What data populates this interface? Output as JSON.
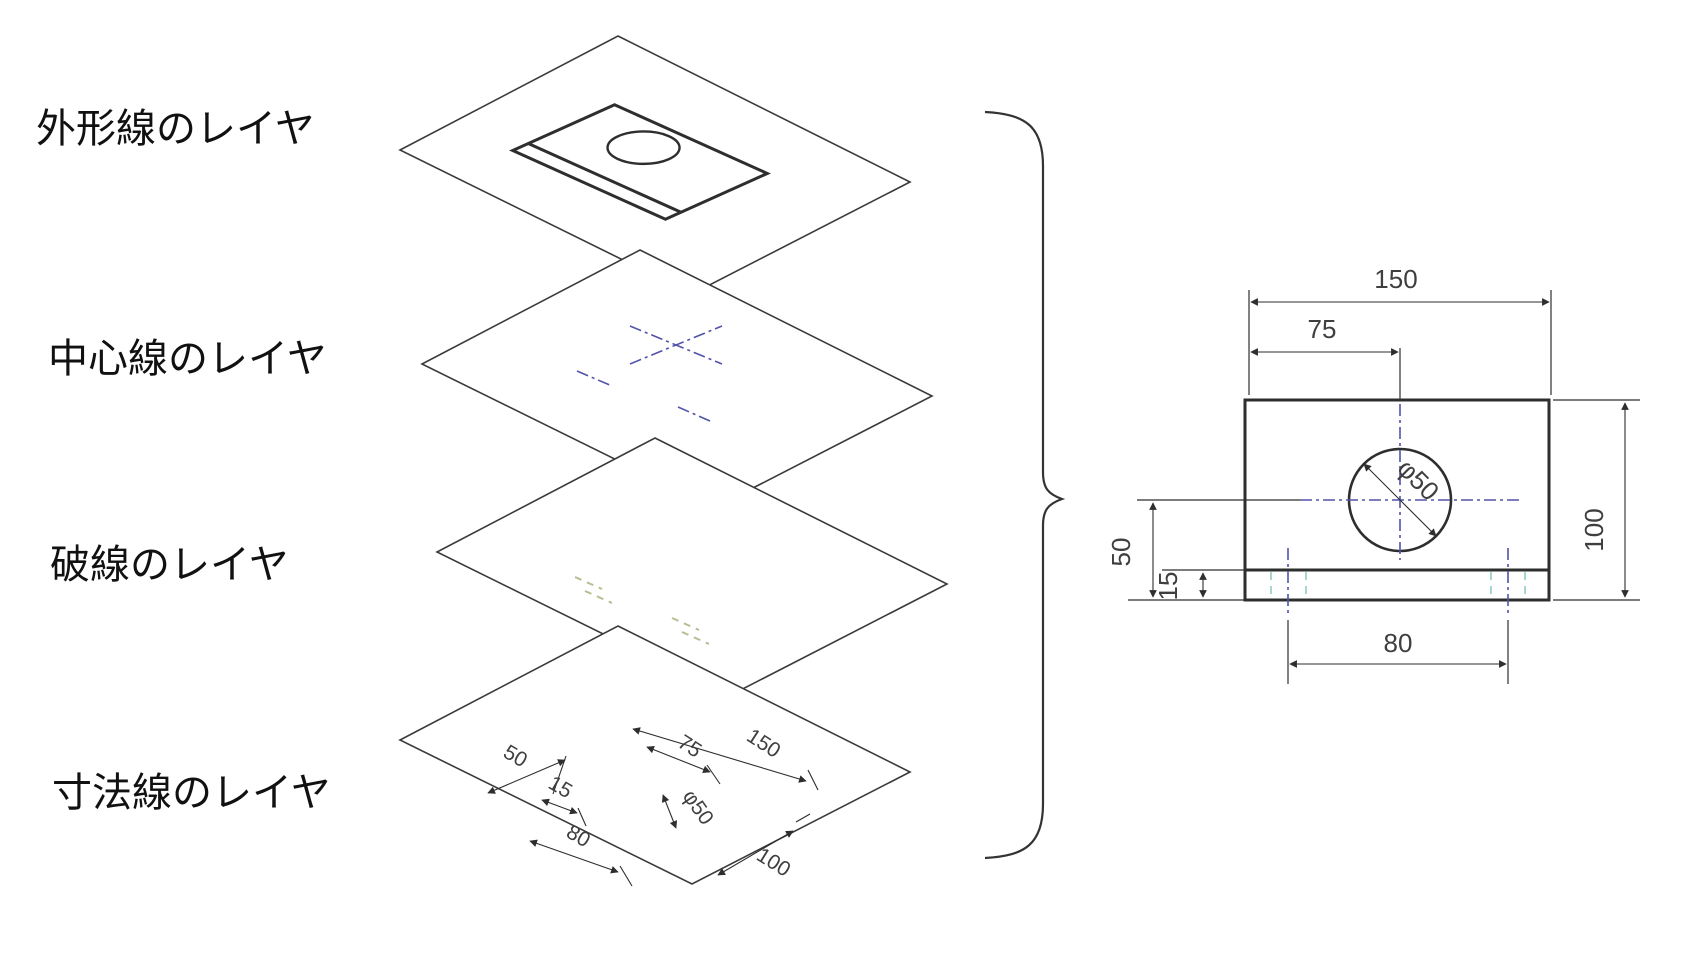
{
  "diagram_title": "CAD layers concept diagram",
  "layers": [
    {
      "label": "外形線のレイヤ"
    },
    {
      "label": "中心線のレイヤ"
    },
    {
      "label": "破線のレイヤ"
    },
    {
      "label": "寸法線のレイヤ"
    }
  ],
  "iso_dims": {
    "d50": "50",
    "d15": "15",
    "d80": "80",
    "d75": "75",
    "d150": "150",
    "dphi": "φ50",
    "d100": "100"
  },
  "drawing_dims": {
    "width": "150",
    "center_x": "75",
    "height": "100",
    "center_y": "50",
    "step": "15",
    "slots": "80",
    "diameter": "φ50"
  },
  "colors": {
    "outline": "#2e2e2e",
    "centerline": "#5252aa",
    "hidden_line": "#92cdc6",
    "hidden_line_iso": "#b9bd93"
  }
}
